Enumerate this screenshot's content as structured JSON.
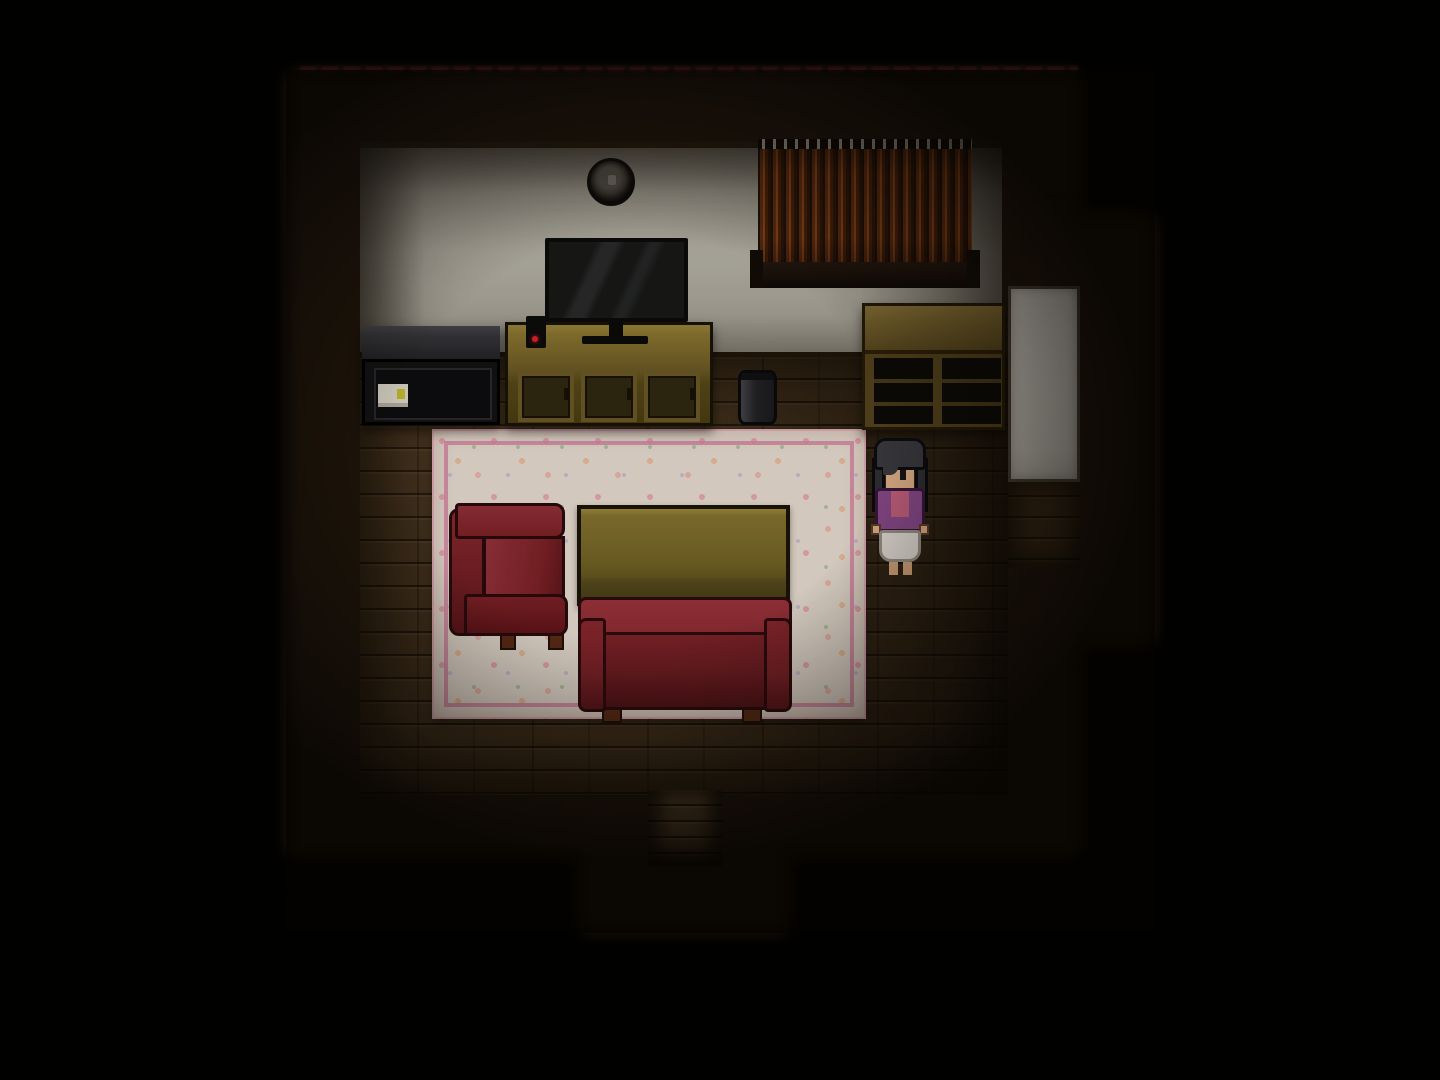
{
  "scene": {
    "title": "Dark pixel-art living room (top-down RPG view)",
    "setting": "A dimly lit wooden-floor living room surrounded by darkness, with exits to the south (corridor) and east (bright doorway)",
    "visible_text": "none",
    "character": {
      "name": "player-character",
      "pose": "standing, facing down",
      "hair": "black bob with side locks",
      "outfit": [
        "purple cardigan",
        "pink shirt",
        "white skirt"
      ],
      "barefoot": true,
      "location": "right of the rug, below the wall shelf"
    },
    "objects": [
      {
        "name": "north-wall",
        "desc": "pale grey plaster wall with dark top trim"
      },
      {
        "name": "wall-clock",
        "desc": "small round dark wall clock"
      },
      {
        "name": "window-curtain",
        "desc": "closed rust-brown striped curtain with ring tabs and dark sill"
      },
      {
        "name": "tv",
        "desc": "flat-screen television with glare streaks on black screen"
      },
      {
        "name": "tv-stand",
        "desc": "golden-brown wooden media cabinet with three doors"
      },
      {
        "name": "tv-remote",
        "desc": "small black device with red power LED on stand"
      },
      {
        "name": "black-cabinet",
        "desc": "low black appliance with white label and yellow sticker"
      },
      {
        "name": "wall-shelf",
        "desc": "brown open shelf unit with two dark compartments"
      },
      {
        "name": "trash-can",
        "desc": "small grey cylindrical bin"
      },
      {
        "name": "area-rug",
        "desc": "cream floral-speckled rug with pink inner border"
      },
      {
        "name": "armchair",
        "desc": "dark red armchair facing right with wooden feet"
      },
      {
        "name": "coffee-table",
        "desc": "olive-yellow rectangular table"
      },
      {
        "name": "sofa",
        "desc": "dark red two-seat sofa facing up with wooden feet"
      },
      {
        "name": "east-door-panel",
        "desc": "bright white door/wall panel in east alcove"
      },
      {
        "name": "south-exit-floor",
        "desc": "plank corridor leading down out of the room"
      }
    ],
    "palette": {
      "shadow_border": "#20160d",
      "wall_light": "#b6b2a7",
      "wall_dim": "#6a665d",
      "floor_base": "#44321f",
      "corridor_floor": "#503c26",
      "alcove_floor": "#3a2a18",
      "white_panel": "#d7d4cb",
      "clock_ring": "#14110e",
      "clock_face": "#4e4a44",
      "curtain_dark": "#2e1608",
      "curtain_mid": "#5e2d12",
      "curtain_light": "#8a4418",
      "tv_bezel": "#0b0b0b",
      "tv_screen": "#181818",
      "stand_top": "#8a7531",
      "stand_front": "#564818",
      "stand_frame": "#6b5a26",
      "stand_panel": "#2f2710",
      "cabinet_top": "#36363b",
      "cabinet_body": "#121215",
      "label_bg": "#ded9cb",
      "label_accent": "#c9be2f",
      "shelf_frame": "#54421c",
      "shelf_top": "#77622e",
      "shelf_dark": "#0c0a07",
      "trash_light": "#44444a",
      "trash_dark": "#1a1a1e",
      "rug_base": "#e9ded3",
      "rug_line": "#d887a5",
      "chair_main": "#7d2127",
      "chair_light": "#95323c",
      "chair_dark": "#5f161c",
      "outline_red": "#2a0b0d",
      "table_top": "#857331",
      "table_front": "#564a1d",
      "table_edge": "#191306",
      "couch_back": "#8e2b33",
      "couch_body": "#6f1d24",
      "couch_arm": "#7c2229",
      "foot_wood": "#5d2c16",
      "hair": "#3a393f",
      "skin": "#e3b28b",
      "jacket": "#8a4a8c",
      "shirt": "#c5617e",
      "skirt": "#e6e1d9",
      "led_red": "#e0202a"
    }
  }
}
